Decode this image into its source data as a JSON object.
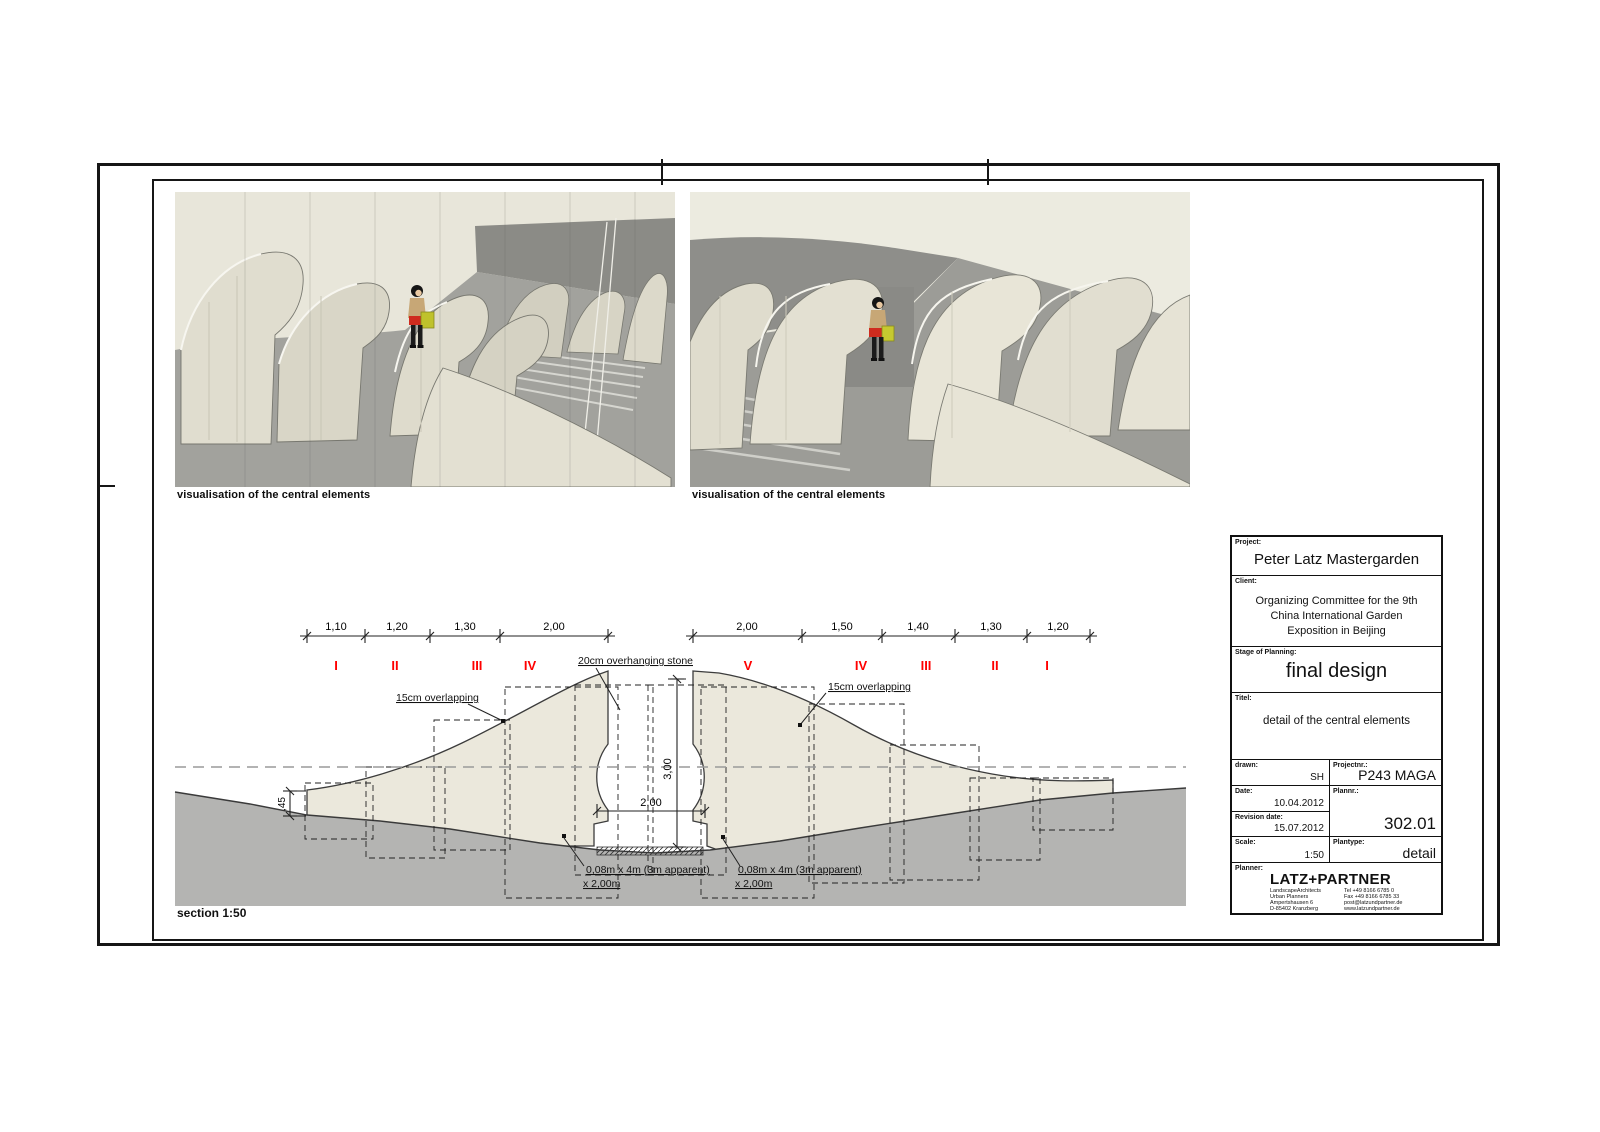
{
  "sheet": {
    "captions": {
      "left": "visualisation of the central elements",
      "right": "visualisation of the central elements"
    },
    "section_label": "section 1:50"
  },
  "section": {
    "dims_left": [
      "1,10",
      "1,20",
      "1,30",
      "2,00"
    ],
    "dims_right": [
      "2,00",
      "1,50",
      "1,40",
      "1,30",
      "1,20"
    ],
    "numerals_left": [
      "I",
      "II",
      "III",
      "IV"
    ],
    "numerals_right": [
      "V",
      "IV",
      "III",
      "II",
      "I"
    ],
    "annotations": {
      "overhang": "20cm overhanging stone",
      "overlap_left": "15cm overlapping",
      "overlap_right": "15cm overlapping",
      "panel_left_line1": "0,08m x 4m (3m apparent)",
      "panel_left_line2": "x 2,00m",
      "panel_right_line1": "0,08m x 4m (3m apparent)",
      "panel_right_line2": "x 2,00m"
    },
    "dimensions": {
      "opening_width": "2,00",
      "opening_height": "3,00",
      "edge_height": ",45"
    },
    "colors": {
      "numeral_red": "#ff0000",
      "stone": "#ebe8dc",
      "ground": "#b4b4b2"
    }
  },
  "titleblock": {
    "project_label": "Project:",
    "project": "Peter Latz Mastergarden",
    "client_label": "Client:",
    "client_lines": [
      "Organizing Committee for the 9th",
      "China International Garden",
      "Exposition in Beijing"
    ],
    "stage_label": "Stage of Planning:",
    "stage": "final design",
    "title_label": "Titel:",
    "title": "detail of the central elements",
    "drawn_label": "drawn:",
    "drawn": "SH",
    "projectnr_label": "Projectnr.:",
    "projectnr": "P243 MAGA",
    "date_label": "Date:",
    "date": "10.04.2012",
    "plannr_label": "Plannr.:",
    "plannr": "302.01",
    "revision_label": "Revision date:",
    "revision": "15.07.2012",
    "scale_label": "Scale:",
    "scale": "1:50",
    "plantype_label": "Plantype:",
    "plantype": "detail",
    "planner_label": "Planner:",
    "firm": "LATZ+PARTNER",
    "firm_left": [
      "LandscapeArchitects",
      "Urban Planners",
      "Ampertshausen 6",
      "D-85402 Kranzberg"
    ],
    "firm_right": [
      "Tel +49 8166 6785 0",
      "Fax +49 8166 6785 33",
      "post@latzundpartner.de",
      "www.latzundpartner.de"
    ]
  }
}
